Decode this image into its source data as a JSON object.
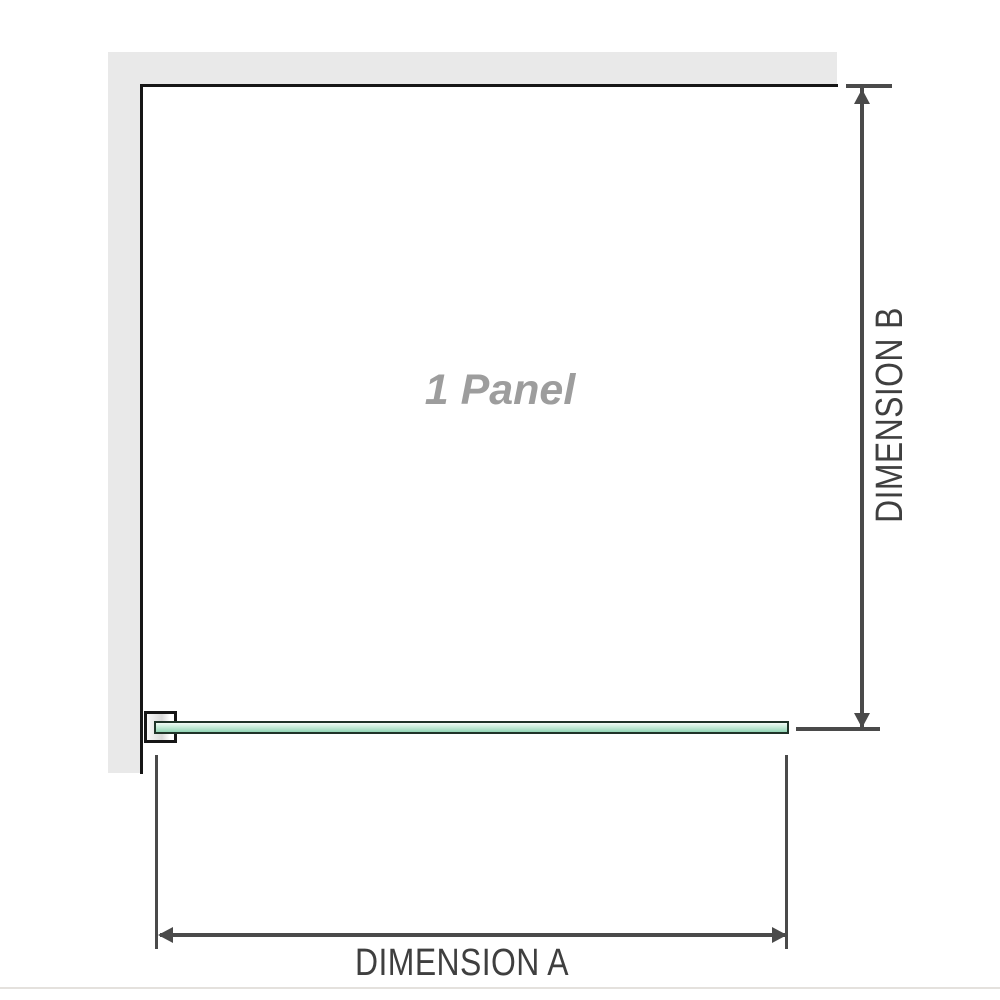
{
  "diagram": {
    "panel_label": "1 Panel",
    "dimension_a": {
      "label": "DIMENSION A"
    },
    "dimension_b": {
      "label": "DIMENSION B"
    }
  },
  "icons": {
    "dimension_b_top": "arrow-up-icon",
    "dimension_b_bottom": "arrow-down-icon",
    "dimension_a_left": "arrow-left-icon",
    "dimension_a_right": "arrow-right-icon"
  },
  "colors": {
    "wall_fill": "#e9e9e9",
    "wall_edge": "#161616",
    "dimension_line": "#4a4a4a",
    "label_text": "#3f3f3f",
    "panel_label_text": "#9d9d9d",
    "glass_border": "#1f3328",
    "glass_light": "#f2fbf6",
    "glass_mid": "#cdeedd",
    "glass_dark": "#92d5b5",
    "bracket_shade": "#d9d9d9",
    "baseline": "#e4e1dd"
  }
}
